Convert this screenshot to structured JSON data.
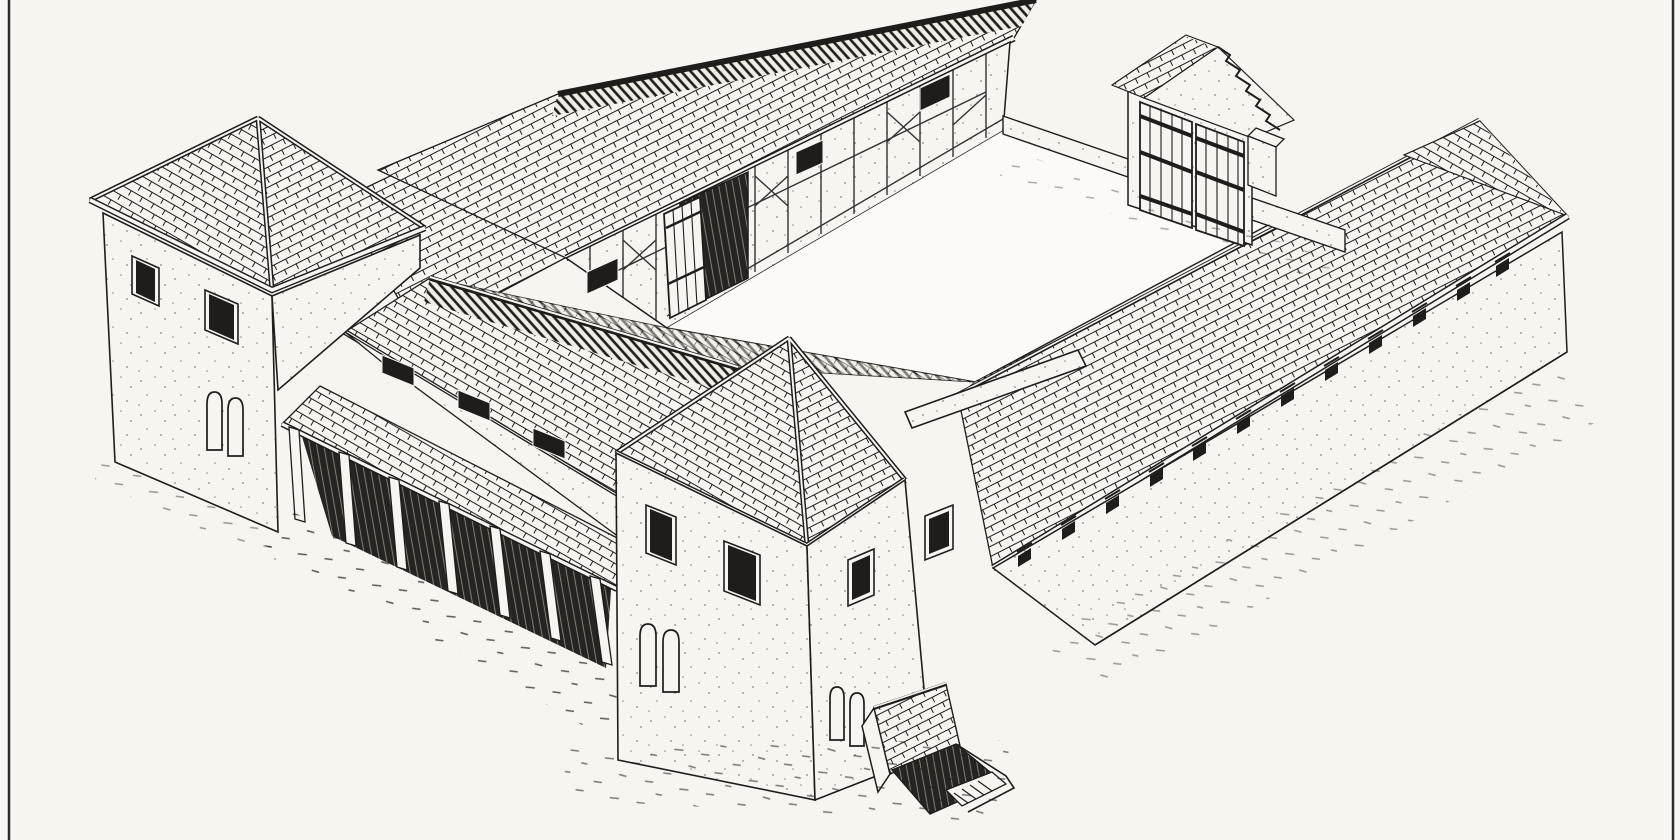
{
  "figure": {
    "kind": "scanned-line-illustration",
    "aria_label": "Axonometric pen-and-ink reconstruction drawing of a Roman courtyard villa: a half-timbered north range with an open plank door, a walled courtyard with a roofed gate of double plank doors, a long tiled east range with eaves vents, two square towers with pyramidal tiled roofs flanking a colonnaded main house, and a small stepped cellar entrance before the near tower."
  },
  "palette": {
    "paper": "#f7f5ef",
    "paper_bright": "#fbfaf6",
    "ink": "#1f1d1a",
    "shadow": "#262420"
  },
  "components": [
    {
      "name": "north-range",
      "label": "half-timbered range",
      "windows": 3,
      "doors": 1
    },
    {
      "name": "gate-house",
      "label": "courtyard gate with gabled tile cap",
      "door_leaves": 2
    },
    {
      "name": "east-range",
      "label": "long tiled range with eaves vents",
      "vents": 12
    },
    {
      "name": "west-tower",
      "label": "square tower, pyramidal tile roof",
      "square_windows": 2,
      "arched_windows": 2
    },
    {
      "name": "south-tower",
      "label": "square corner tower, pyramidal tile roof",
      "square_windows": 4,
      "arched_windows": 4
    },
    {
      "name": "main-house",
      "label": "dwelling with lean-to colonnade",
      "portico_posts": 7,
      "slit_windows": 3
    },
    {
      "name": "cellar-entrance",
      "label": "stepped cellar entry with small tiled roof"
    },
    {
      "name": "courtyard",
      "label": "open inner courtyard"
    }
  ]
}
